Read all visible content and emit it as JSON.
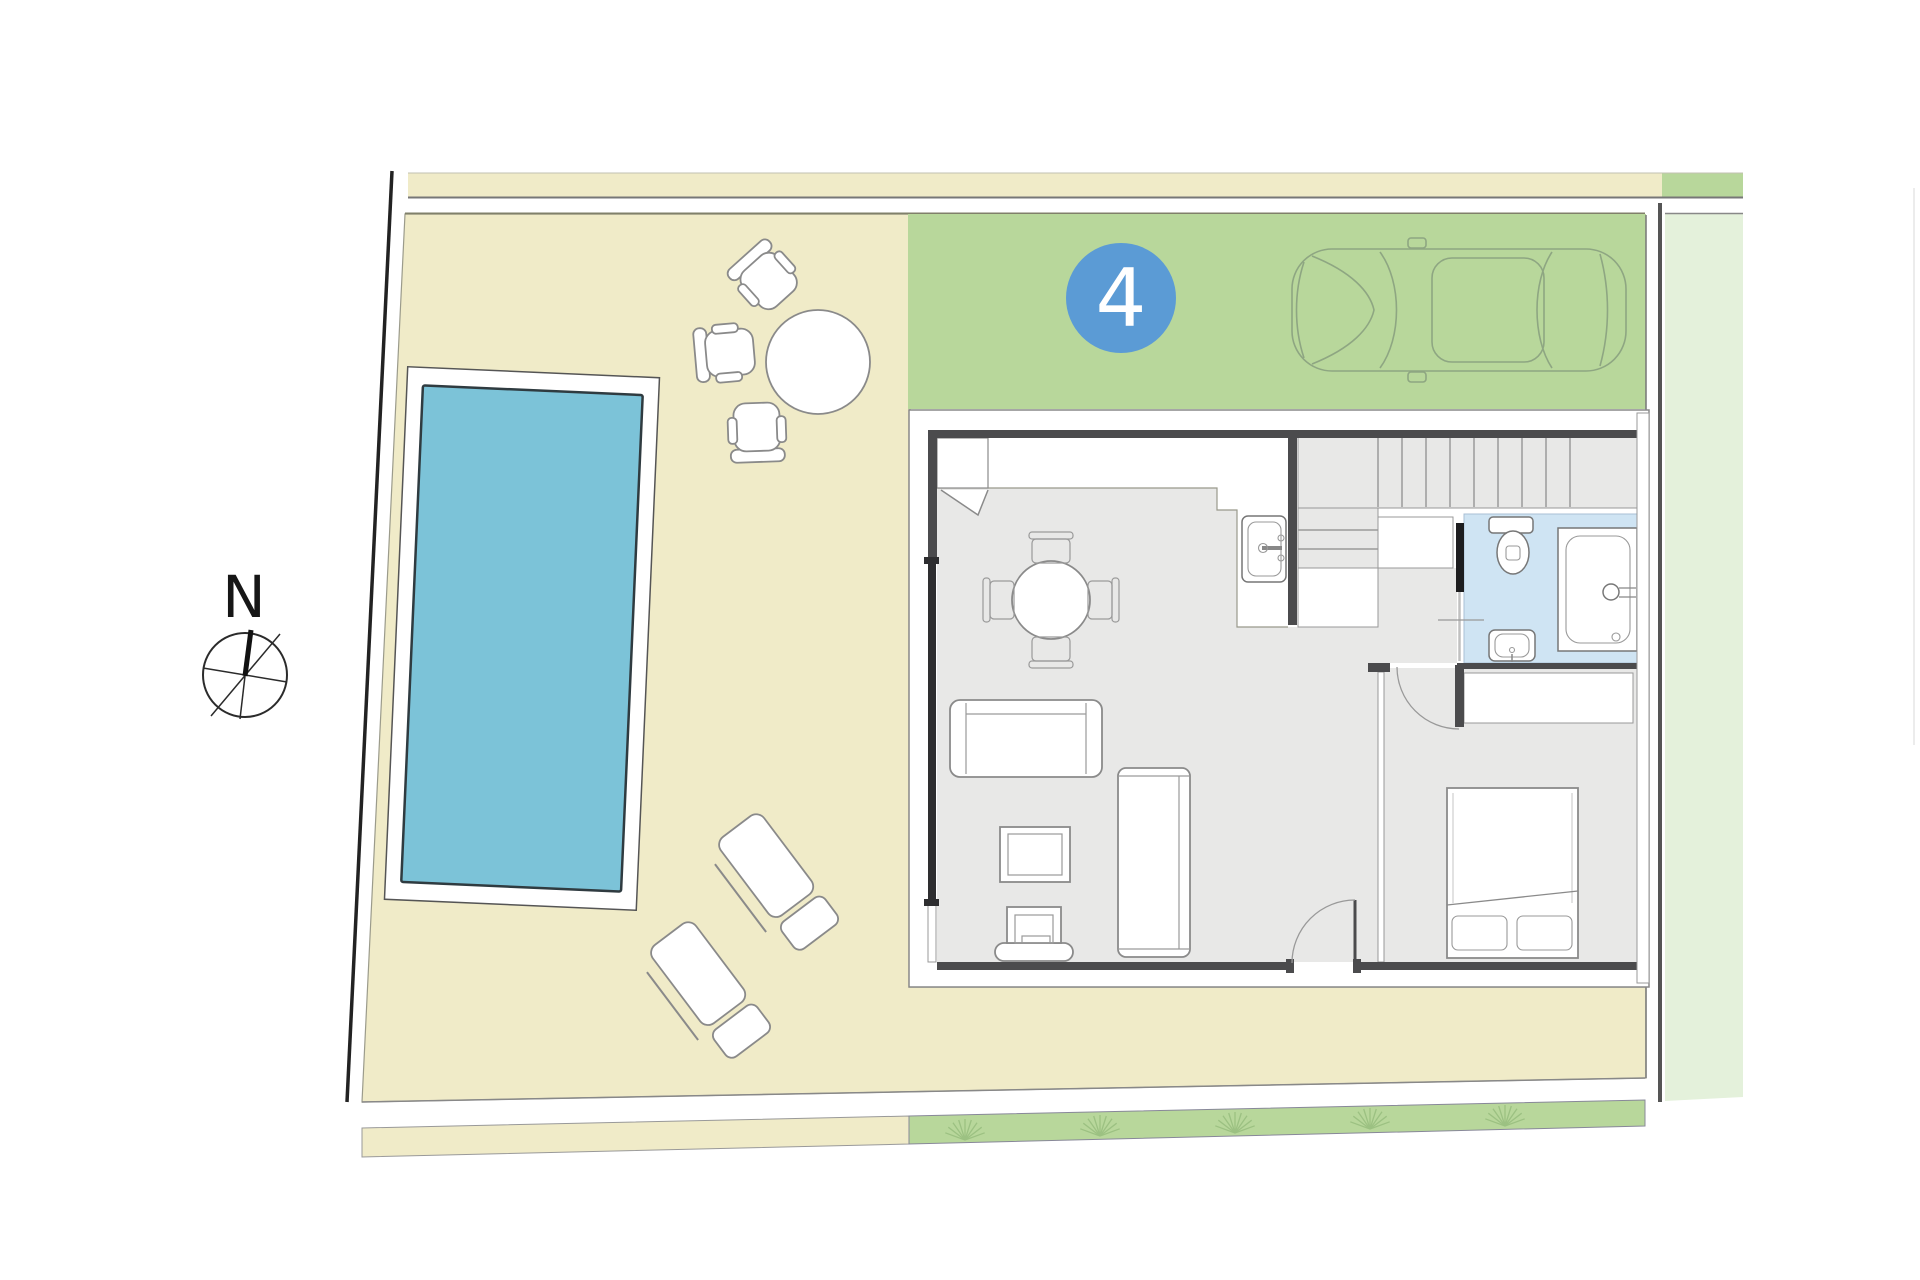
{
  "document": {
    "type": "site-and-floor-plan",
    "unit": {
      "number": "4"
    },
    "compass": {
      "label": "N"
    }
  },
  "colors": {
    "garden": "#f0ebc8",
    "grass": "#b8d79b",
    "grass-light": "#e4f1db",
    "water": "#7cc3d8",
    "water-edge": "#2f3b40",
    "bath": "#cfe4f3",
    "floor": "#e8e8e7",
    "wall": "#4b4b4d",
    "line": "#8a8a8a",
    "dark-line": "#222222",
    "badge": "#5b9bd5",
    "badge-text": "#ffffff",
    "car-line": "#8ea682",
    "grass-line": "#9cc182"
  },
  "site": {
    "areas": [
      "sidewalk-strip",
      "garden",
      "driveway",
      "pool",
      "pool-deck",
      "hedge-strip",
      "side-green-band",
      "plot-boundary"
    ]
  },
  "garden": {
    "furniture": [
      "outdoor-table",
      "outdoor-chair",
      "outdoor-chair",
      "outdoor-chair",
      "sun-lounger",
      "sun-lounger"
    ]
  },
  "house": {
    "rooms": [
      "living-dining-kitchen",
      "staircase",
      "bathroom",
      "bedroom",
      "hallway"
    ],
    "fixtures": [
      "kitchen-sink",
      "toilet",
      "wash-basin",
      "bathtub",
      "stairs",
      "wardrobe"
    ],
    "furniture": [
      "dining-table",
      "dining-chair-x4",
      "sofa",
      "coffee-table",
      "tv-unit",
      "tall-cabinet",
      "double-bed",
      "pillows"
    ]
  },
  "vehicle": {
    "type": "car-top-view"
  }
}
